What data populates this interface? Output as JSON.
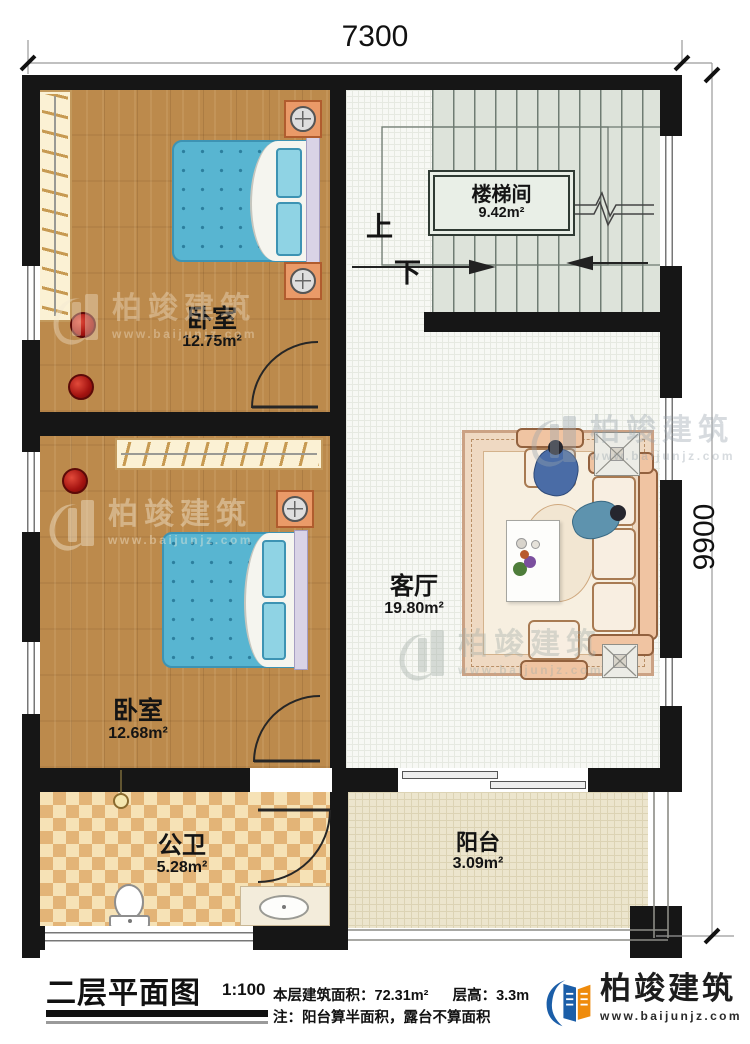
{
  "dimensions": {
    "top": "7300",
    "right": "9900"
  },
  "rooms": {
    "bedroom1": {
      "label": "卧室",
      "area": "12.75m²"
    },
    "bedroom2": {
      "label": "卧室",
      "area": "12.68m²"
    },
    "stairwell": {
      "label": "楼梯间",
      "area": "9.42m²"
    },
    "living": {
      "label": "客厅",
      "area": "19.80m²"
    },
    "bathroom": {
      "label": "公卫",
      "area": "5.28m²"
    },
    "balcony": {
      "label": "阳台",
      "area": "3.09m²"
    }
  },
  "stairs": {
    "up": "上",
    "down": "下"
  },
  "titleblock": {
    "title": "二层平面图",
    "scale": "1:100",
    "area_line": "本层建筑面积：72.31m²",
    "height_line": "层高：3.3m",
    "note_line": "注：阳台算半面积，露台不算面积"
  },
  "brand": {
    "name": "柏竣建筑",
    "url": "www.baijunjz.com"
  },
  "watermark": {
    "name": "柏竣建筑",
    "url": "www.baijunjz.com"
  },
  "colors": {
    "wall": "#161616",
    "wood": "#bc8a4c",
    "mattress": "#58b5d1",
    "stair_floor": "#dde3da",
    "tile_dark": "#e3b477",
    "tile_light": "#f6e2b6",
    "balcony_floor": "#ece5cd",
    "brand_blue": "#1b5ea8",
    "brand_orange": "#ef8b0c"
  }
}
